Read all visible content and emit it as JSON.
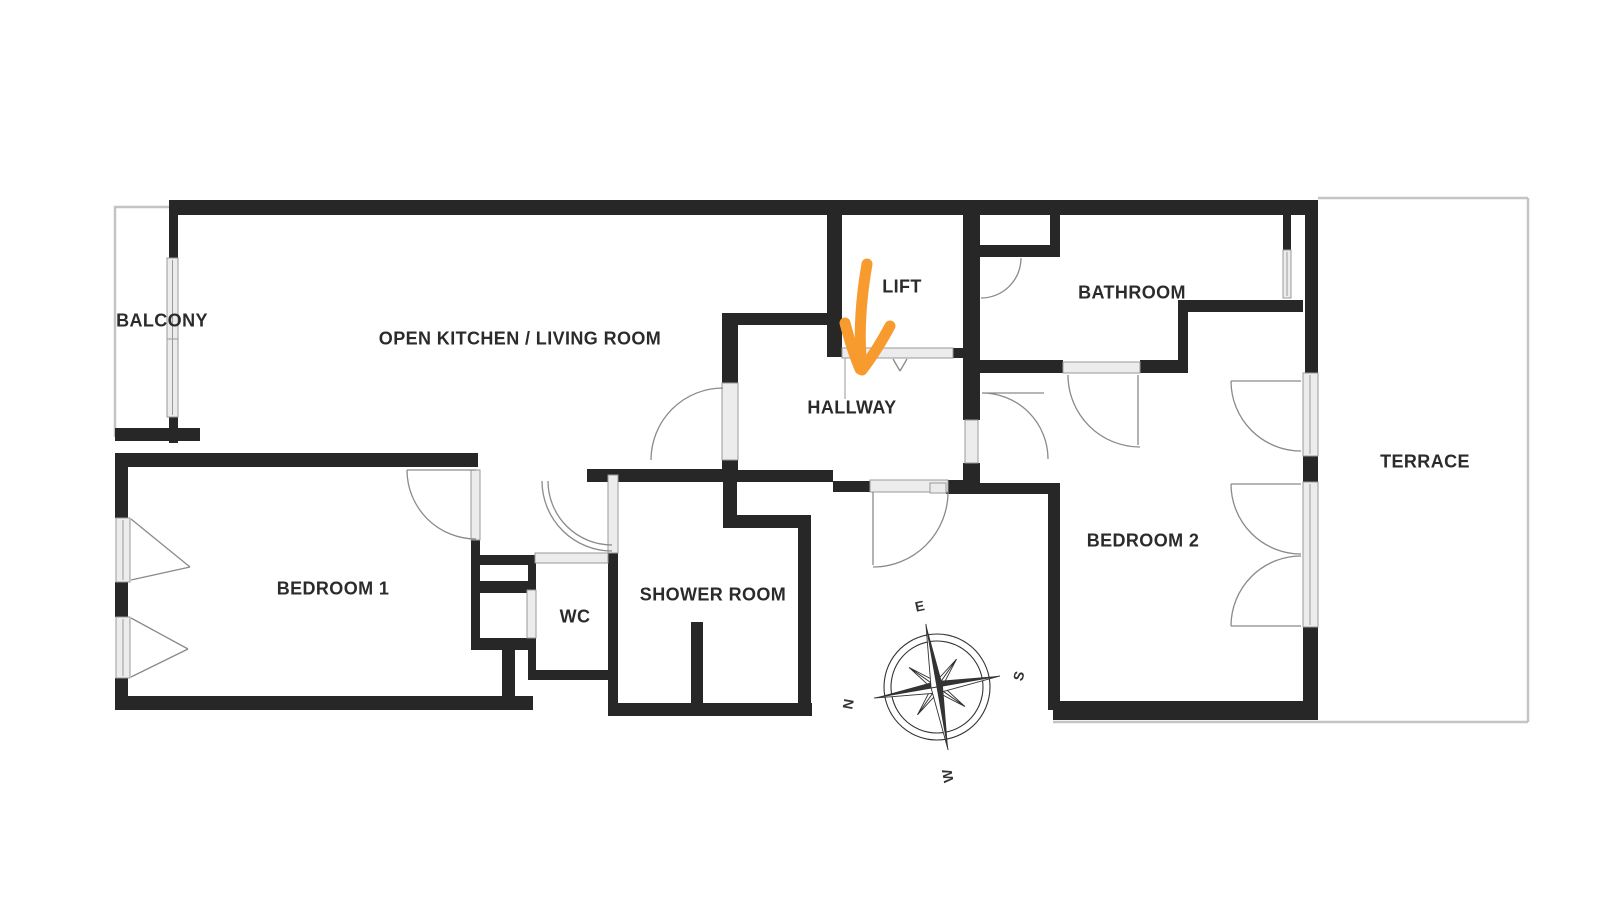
{
  "page": {
    "background": "#ffffff"
  },
  "colors": {
    "wall": "#272727",
    "sill_fill": "#ececec",
    "sill_stroke": "#9a9a9a",
    "thin_line": "#c4c4c4",
    "arc": "#8a8a8a",
    "label_text": "#2b2b2b",
    "arrow": "#F89B2E",
    "compass": "#333333"
  },
  "floorplan": {
    "rooms": {
      "balcony": {
        "label": "BALCONY"
      },
      "kitchen_living": {
        "label": "OPEN KITCHEN / LIVING ROOM"
      },
      "lift": {
        "label": "LIFT"
      },
      "hallway": {
        "label": "HALLWAY"
      },
      "bathroom": {
        "label": "BATHROOM"
      },
      "bedroom2": {
        "label": "BEDROOM 2"
      },
      "terrace": {
        "label": "TERRACE"
      },
      "bedroom1": {
        "label": "BEDROOM 1"
      },
      "wc": {
        "label": "WC"
      },
      "shower": {
        "label": "SHOWER ROOM"
      }
    },
    "compass": {
      "east": "E",
      "south": "S",
      "west": "W",
      "north": "N"
    }
  }
}
